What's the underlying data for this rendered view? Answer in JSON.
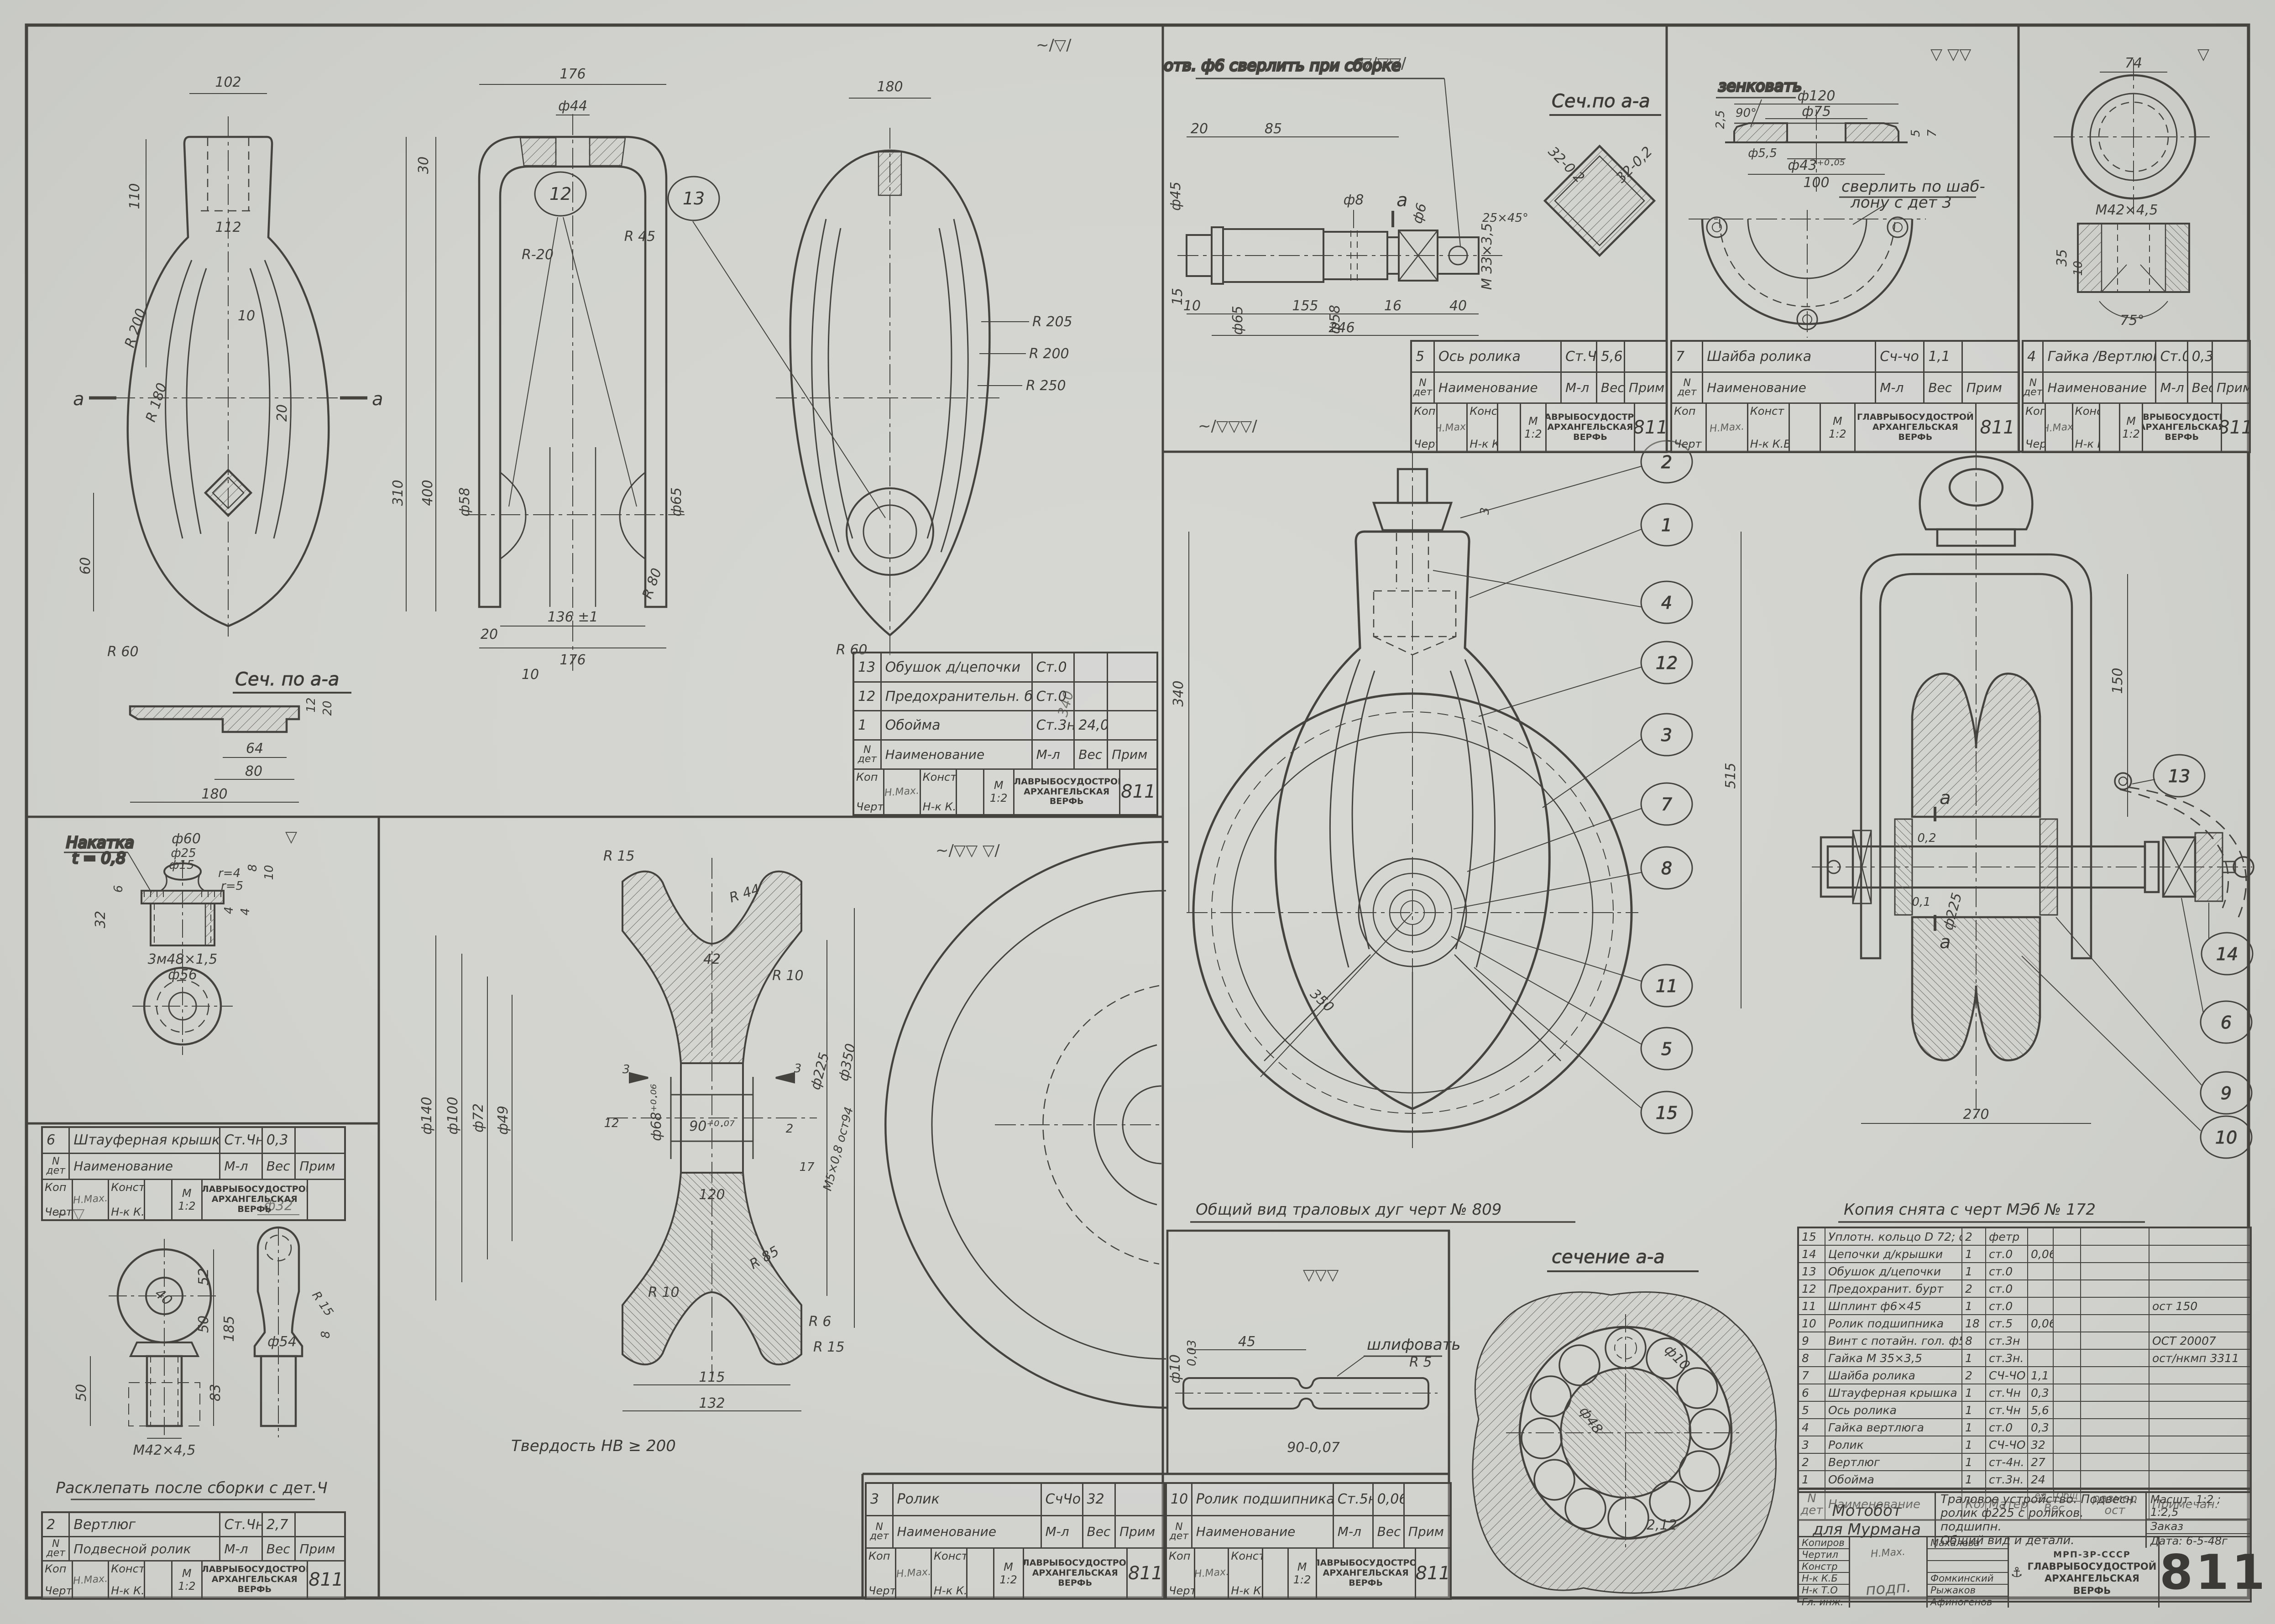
{
  "sheet": {
    "number": "811",
    "paper": "#d3d4d0",
    "ink": "#3b3a36"
  },
  "marks": {
    "frame_panel": "∼/▽/",
    "axle_panel": "▽/▽▽/",
    "washer_panel": "▽ ▽▽",
    "nut_panel": "▽",
    "stauffer_panel": "▽",
    "swivel_panel": "∼ ▽",
    "sheave_panel": "∼/▽▽ ▽/",
    "assembly_panel": "∼/▽▽▽/",
    "bearing_box": "▽▽▽",
    "small": "▽"
  },
  "notes": {
    "axle_drill": "отв. ф6 сверлить при сборке",
    "sech_sq_title": "Сеч.по а-а",
    "sech_left_title": "Сеч. по а-а",
    "zenkovat": "зенковать",
    "drill_template_1": "сверлить по шаб-",
    "drill_template_2": "лону с дет 3",
    "nakatka_1": "Накатка",
    "nakatka_2": "t = 0,8",
    "rasklepat": "Расклепать после сборки с дет.Ч",
    "tverdost": "Твердость НВ ≥ 200",
    "obshiy_vid": "Общий вид траловых дуг  черт № 809",
    "kopiya": "Копия снята с черт МЭб  № 172",
    "sechenie_aa": "сечение а-а",
    "shlifovat": "шлифовать"
  },
  "views": {
    "frame_front": {
      "dims": [
        "102",
        "110",
        "112",
        "30",
        "10",
        "20",
        "R 180",
        "R 200",
        "310",
        "400",
        "60",
        "R 60",
        "а",
        "а"
      ]
    },
    "frame_side": {
      "dims": [
        "176",
        "ф44",
        "R-20",
        "R 45",
        "10",
        "ф58",
        "ф65",
        "20",
        "136 ±1",
        "176",
        "R 80",
        "340"
      ]
    },
    "frame_oval": {
      "dims": [
        "180",
        "R 205",
        "R 200",
        "R 250",
        "R 60"
      ]
    },
    "sech_left": {
      "dims": [
        "64",
        "80",
        "180",
        "12",
        "20"
      ]
    },
    "axle": {
      "dims": [
        "20",
        "85",
        "ф45",
        "ф8",
        "ф6",
        "М 33×3,5",
        "25×45°",
        "10",
        "155",
        "16",
        "40",
        "246",
        "15",
        "ф65",
        "ф58",
        "а"
      ]
    },
    "sech_sq": {
      "dims": [
        "32-0,2",
        "32-0,2"
      ]
    },
    "washer": {
      "dims": [
        "ф120",
        "ф75",
        "90°",
        "2,5",
        "ф5,5",
        "ф43⁺⁰·⁰⁵",
        "100",
        "5",
        "7"
      ]
    },
    "nut": {
      "dims": [
        "74",
        "М42×4,5",
        "35",
        "10",
        "75°"
      ]
    },
    "stauffer": {
      "dims": [
        "ф60",
        "ф25",
        "ф15",
        "r=4",
        "r=5",
        "6",
        "32",
        "8",
        "10",
        "4",
        "4",
        "3м48×1,5",
        "ф56"
      ]
    },
    "swivel": {
      "dims": [
        "40",
        "52",
        "50",
        "185",
        "83",
        "50",
        "М42×4,5",
        "ф32",
        "R 15",
        "8",
        "ф54"
      ]
    },
    "sheave": {
      "dims": [
        "R 15",
        "R 44",
        "42",
        "R 10",
        "ф140",
        "ф100",
        "ф72",
        "ф49",
        "ф68⁺⁰·⁰⁶",
        "90⁺⁰·⁰⁷",
        "12",
        "3",
        "3",
        "2",
        "17",
        "120",
        "М5×0,8 ост94",
        "ф225",
        "ф350",
        "R 85",
        "R 6",
        "R 15",
        "115",
        "132",
        "R 10"
      ]
    },
    "asm_front": {
      "dims": [
        "340",
        "3",
        "350",
        "515"
      ]
    },
    "asm_side": {
      "dims": [
        "150",
        "270",
        "ф225",
        "0,2",
        "0,1",
        "а",
        "а"
      ]
    },
    "bearing": {
      "dims": [
        "45",
        "ф10",
        "R 5",
        "90-0,07",
        "0,03"
      ]
    },
    "section_big": {
      "dims": [
        "ф10",
        "ф48",
        "2,12"
      ]
    }
  },
  "balloons": {
    "front": [
      "2",
      "1",
      "4",
      "12",
      "3",
      "7",
      "8",
      "11",
      "5",
      "15"
    ],
    "side": [
      "13",
      "14",
      "6",
      "9",
      "10"
    ],
    "frame": [
      "12",
      "13"
    ]
  },
  "mini_common": {
    "n1": "N",
    "n2": "дет",
    "naim": "Наименование",
    "ml": "М-л",
    "ves": "Вес",
    "prim": "Прим",
    "kop": "Коп",
    "chert": "Черт",
    "konst": "Конст",
    "nk1": "Н-к",
    "nk2": "К.Б",
    "m": "М",
    "scale": "1:2",
    "org1": "ГЛАВРЫБОСУДОСТРОЙ",
    "org2": "АРХАНГЕЛЬСКАЯ",
    "org3": "ВЕРФЬ",
    "num": "811",
    "sig": "Н.Мах."
  },
  "minis": {
    "obushok": {
      "hdr": "Наименование",
      "rows": [
        {
          "num": "13",
          "name": "Обушок д/цепочки",
          "mat": "Ст.0",
          "wt": ""
        },
        {
          "num": "12",
          "name": "Предохранительн. бурт",
          "mat": "Ст.0",
          "wt": ""
        },
        {
          "num": "1",
          "name": "Обойма",
          "mat": "Ст.3н.",
          "wt": "24,0"
        }
      ]
    },
    "stauffer": {
      "hdr": "Наименование",
      "rows": [
        {
          "num": "6",
          "name": "Штауферная крышка",
          "mat": "Ст.Чн",
          "wt": "0,3"
        }
      ]
    },
    "swivel": {
      "hdr": "Подвесной ролик",
      "rows": [
        {
          "num": "2",
          "name": "Вертлюг",
          "mat": "Ст.Чн",
          "wt": "2,7"
        }
      ]
    },
    "sheave": {
      "hdr": "Наименование",
      "rows": [
        {
          "num": "3",
          "name": "Ролик",
          "mat": "СчЧо",
          "wt": "32"
        }
      ]
    },
    "roller": {
      "hdr": "Наименование",
      "rows": [
        {
          "num": "10",
          "name": "Ролик подшипника",
          "mat": "Ст.5н",
          "wt": "0,06"
        }
      ]
    },
    "axis": {
      "hdr": "Наименование",
      "rows": [
        {
          "num": "5",
          "name": "Ось ролика",
          "mat": "Ст.Чн",
          "wt": "5,6"
        }
      ]
    },
    "shajba": {
      "hdr": "Наименование",
      "rows": [
        {
          "num": "7",
          "name": "Шайба ролика",
          "mat": "Сч-чо",
          "wt": "1,1"
        }
      ]
    },
    "gajka": {
      "hdr": "Наименование",
      "rows": [
        {
          "num": "4",
          "name": "Гайка /Вертлюга/",
          "mat": "Ст.0",
          "wt": "0,3"
        }
      ]
    }
  },
  "parts_table": {
    "hdr": {
      "n1": "N",
      "n2": "дет",
      "name": "Наименование",
      "qty": "Кол.",
      "mat": "Матер",
      "ed": "ед",
      "ob": "Общ",
      "ves": "Вес",
      "raz1": "размер",
      "raz2": "ост",
      "prim": "Примечан."
    },
    "rows": [
      {
        "n": "15",
        "name": "Уплотн. кольцо D 72; d-47,63мм",
        "qty": "2",
        "mat": "фетр",
        "w1": "",
        "w2": "",
        "raz": "",
        "prim": ""
      },
      {
        "n": "14",
        "name": "Цепочки д/крышки",
        "qty": "1",
        "mat": "ст.0",
        "w1": "0,06",
        "w2": "",
        "raz": "",
        "prim": ""
      },
      {
        "n": "13",
        "name": "Обушок д/цепочки",
        "qty": "1",
        "mat": "ст.0",
        "w1": "",
        "w2": "",
        "raz": "",
        "prim": ""
      },
      {
        "n": "12",
        "name": "Предохранит. бурт",
        "qty": "2",
        "mat": "ст.0",
        "w1": "",
        "w2": "",
        "raz": "",
        "prim": ""
      },
      {
        "n": "11",
        "name": "Шплинт ф6×45",
        "qty": "1",
        "mat": "ст.0",
        "w1": "",
        "w2": "",
        "raz": "",
        "prim": "ост 150"
      },
      {
        "n": "10",
        "name": "Ролик подшипника",
        "qty": "18",
        "mat": "ст.5",
        "w1": "0,06",
        "w2": "",
        "raz": "",
        "prim": ""
      },
      {
        "n": "9",
        "name": "Винт с потайн. гол. ф5×18",
        "qty": "8",
        "mat": "ст.3н",
        "w1": "",
        "w2": "",
        "raz": "",
        "prim": "ОСТ 20007"
      },
      {
        "n": "8",
        "name": "Гайка М 35×3,5",
        "qty": "1",
        "mat": "ст.3н.",
        "w1": "",
        "w2": "",
        "raz": "",
        "prim": "ост/нкмп 3311"
      },
      {
        "n": "7",
        "name": "Шайба ролика",
        "qty": "2",
        "mat": "СЧ-ЧО",
        "w1": "1,1",
        "w2": "",
        "raz": "",
        "prim": ""
      },
      {
        "n": "6",
        "name": "Штауферная крышка",
        "qty": "1",
        "mat": "ст.Чн",
        "w1": "0,3",
        "w2": "",
        "raz": "",
        "prim": ""
      },
      {
        "n": "5",
        "name": "Ось ролика",
        "qty": "1",
        "mat": "ст.Чн",
        "w1": "5,6",
        "w2": "",
        "raz": "",
        "prim": ""
      },
      {
        "n": "4",
        "name": "Гайка вертлюга",
        "qty": "1",
        "mat": "ст.0",
        "w1": "0,3",
        "w2": "",
        "raz": "",
        "prim": ""
      },
      {
        "n": "3",
        "name": "Ролик",
        "qty": "1",
        "mat": "СЧ-ЧО",
        "w1": "32",
        "w2": "",
        "raz": "",
        "prim": ""
      },
      {
        "n": "2",
        "name": "Вертлюг",
        "qty": "1",
        "mat": "ст-4н.",
        "w1": "27",
        "w2": "",
        "raz": "",
        "prim": ""
      },
      {
        "n": "1",
        "name": "Обойма",
        "qty": "1",
        "mat": "ст.3н.",
        "w1": "24",
        "w2": "",
        "raz": "",
        "prim": ""
      }
    ]
  },
  "title_block": {
    "object1": "Мотобот",
    "object2": "для Мурмана",
    "title1": "Траловое устройство. Подвесн.",
    "title2": "ролик ф225 с роликов. подшипн.",
    "title3": "Общий вид и детали.",
    "scale": "Масшт. 1:2 ; 1:2,5",
    "order": "Заказ",
    "date": "Дата: 6-5-48г",
    "signs": [
      {
        "role": "Копиров",
        "sig": "Н.Мах.",
        "name": "Махалова"
      },
      {
        "role": "Чертил",
        "sig": "",
        "name": ""
      },
      {
        "role": "Констр",
        "sig": "",
        "name": ""
      },
      {
        "role": "Н-к К.Б",
        "sig": "подп.",
        "name": "Фомкинский"
      },
      {
        "role": "Н-к Т.О",
        "sig": "",
        "name": "Рыжаков"
      },
      {
        "role": "Гл. инж.",
        "sig": "",
        "name": "Афиногенов"
      }
    ],
    "org": {
      "abbr": "МРП-ЗР-СССР",
      "main": "ГЛАВРЫБОСУДОСТРОЙ",
      "city": "АРХАНГЕЛЬСКАЯ",
      "werf": "ВЕРФЬ",
      "logo": "⚓"
    },
    "number": "811"
  }
}
